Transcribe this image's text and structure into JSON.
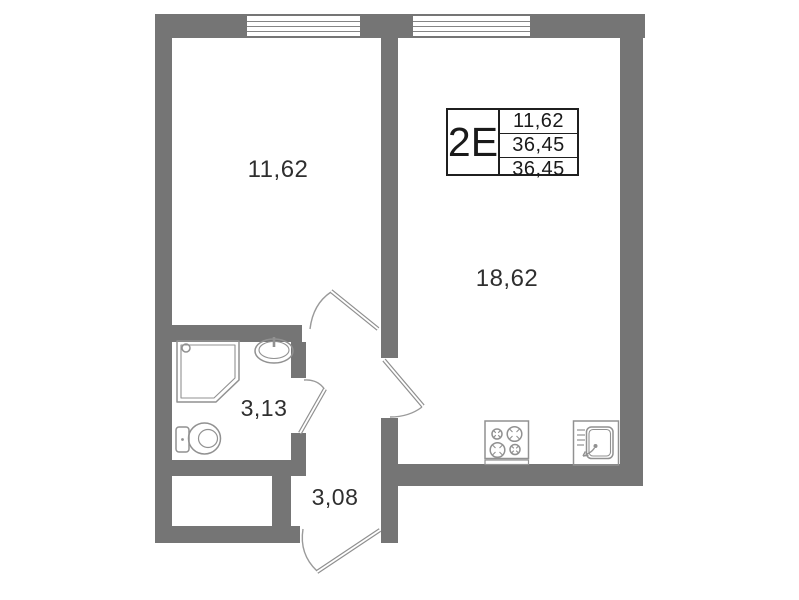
{
  "floorplan": {
    "unit": {
      "type_label": "2Е",
      "area_rows": [
        "11,62",
        "36,45",
        "36,45"
      ]
    },
    "rooms": {
      "bedroom": {
        "area": "11,62"
      },
      "living_kitchen": {
        "area": "18,62"
      },
      "bathroom": {
        "area": "3,13"
      },
      "hallway": {
        "area": "3,08"
      }
    },
    "icons": [
      "shower-icon",
      "washbasin-icon",
      "toilet-icon",
      "stove-icon",
      "kitchen-sink-icon",
      "window-icon",
      "door-swing-icon"
    ],
    "colors": {
      "wall": "#757575",
      "fixture_line": "#949494",
      "label_text": "#2f2f2f",
      "table_border": "#1f1f1f",
      "background": "#ffffff"
    }
  }
}
